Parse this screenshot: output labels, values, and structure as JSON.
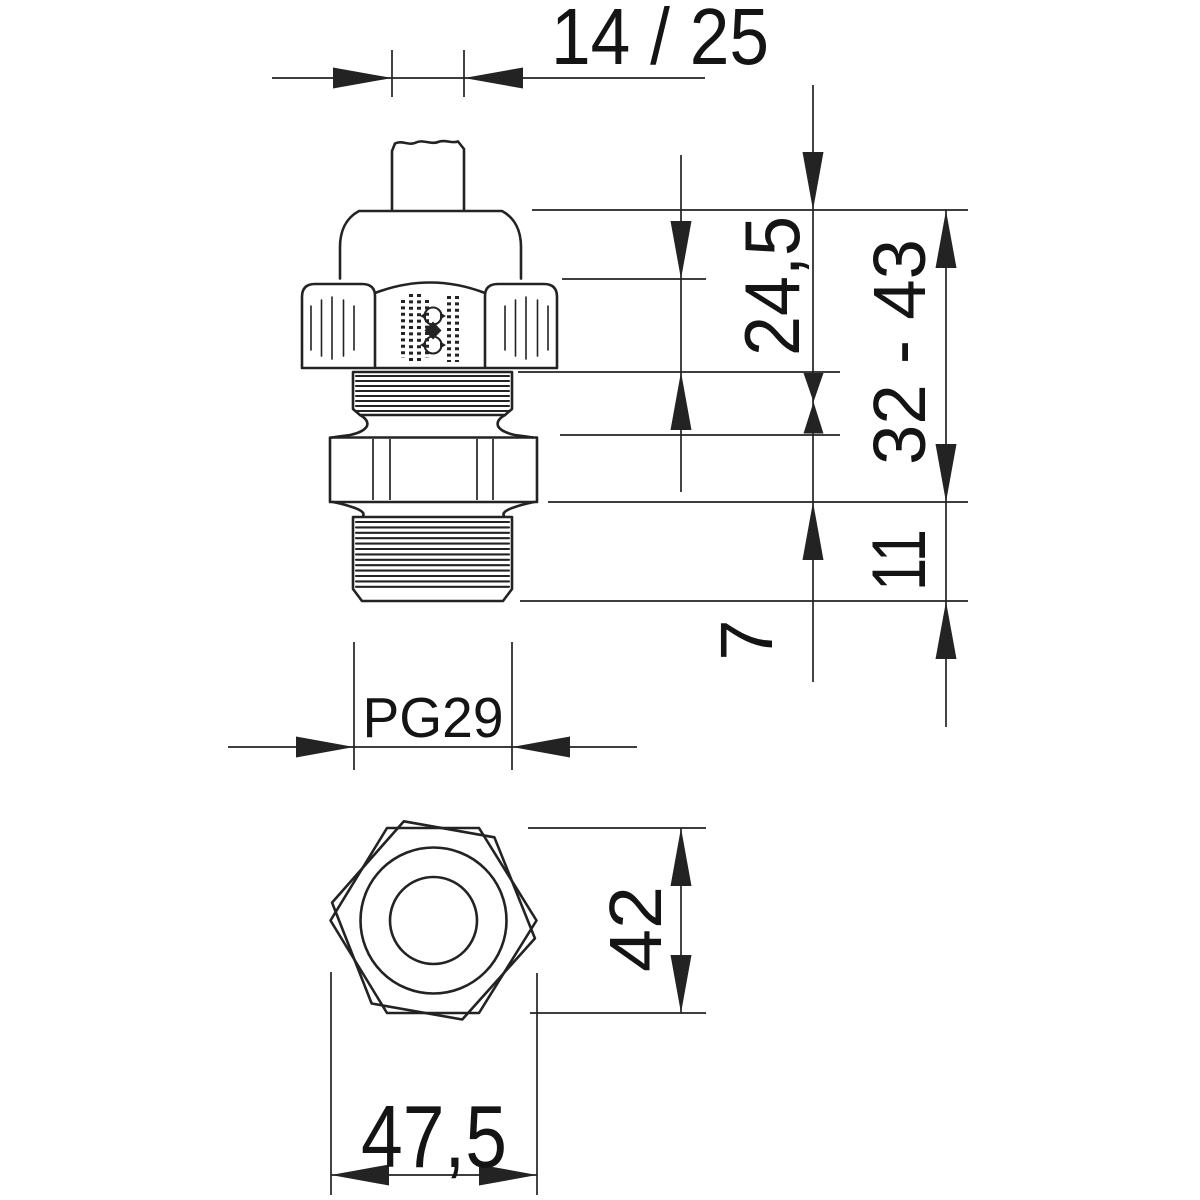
{
  "drawing": {
    "kind": "technical dimension drawing",
    "part": "metric cable gland, side view and bottom hex view",
    "unit_style": "millimetres with decimal comma",
    "colors": {
      "line": "#232323",
      "background": "#ffffff",
      "text": "#141414"
    },
    "labels": {
      "cable_range": "14 / 25",
      "cap_section_height": "24,5",
      "overall_height_range": "32 - 43",
      "thread_length": "11",
      "hex_height": "7",
      "thread_size": "PG29",
      "width_across_flats": "42",
      "width_across_corners": "47,5"
    }
  }
}
